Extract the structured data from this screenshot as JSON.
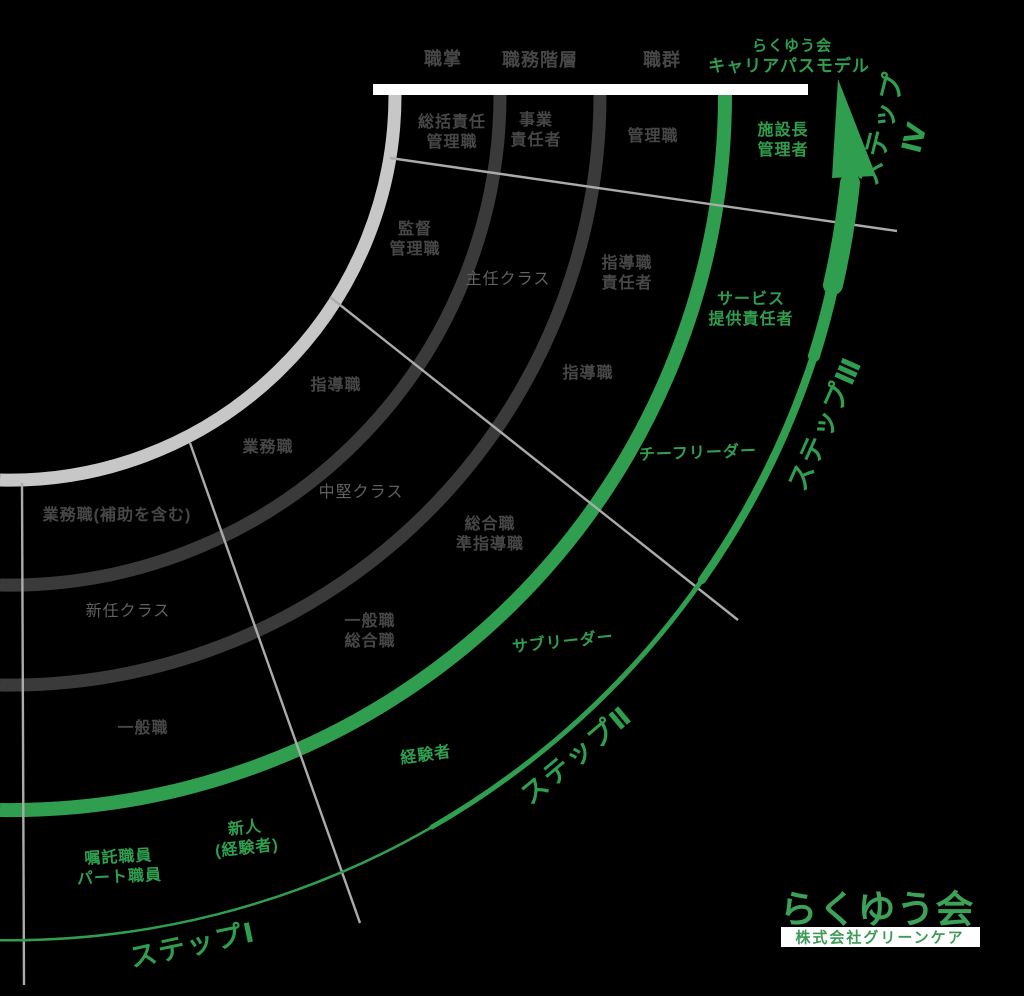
{
  "title": {
    "line1": "らくゆう会",
    "line2": "キャリアパスモデル"
  },
  "columns": [
    {
      "label": "職掌",
      "x": 443,
      "y": 59
    },
    {
      "label": "職務階層",
      "x": 540,
      "y": 60
    },
    {
      "label": "職群",
      "x": 662,
      "y": 60
    }
  ],
  "cells": [
    {
      "text": "総括責任\n管理職",
      "tone": "dark",
      "x": 452,
      "y": 133
    },
    {
      "text": "監督\n管理職",
      "tone": "dark",
      "x": 415,
      "y": 240
    },
    {
      "text": "指導職",
      "tone": "dark",
      "x": 336,
      "y": 386
    },
    {
      "text": "業務職",
      "tone": "dark",
      "x": 268,
      "y": 448
    },
    {
      "text": "業務職(補助を含む)",
      "tone": "dark",
      "x": 117,
      "y": 516
    },
    {
      "text": "事業\n責任者",
      "tone": "dark",
      "x": 536,
      "y": 131
    },
    {
      "text": "主任クラス",
      "tone": "muted",
      "x": 508,
      "y": 280
    },
    {
      "text": "中堅クラス",
      "tone": "muted",
      "x": 361,
      "y": 493
    },
    {
      "text": "新任クラス",
      "tone": "muted",
      "x": 128,
      "y": 612
    },
    {
      "text": "管理職",
      "tone": "dark",
      "x": 653,
      "y": 137
    },
    {
      "text": "指導職\n責任者",
      "tone": "dark",
      "x": 627,
      "y": 274
    },
    {
      "text": "指導職",
      "tone": "dark",
      "x": 588,
      "y": 374
    },
    {
      "text": "総合職\n準指導職",
      "tone": "dark",
      "x": 490,
      "y": 535
    },
    {
      "text": "一般職\n総合職",
      "tone": "dark",
      "x": 370,
      "y": 632
    },
    {
      "text": "一般職",
      "tone": "dark",
      "x": 143,
      "y": 729
    },
    {
      "text": "施設長\n管理者",
      "tone": "green",
      "x": 783,
      "y": 141
    },
    {
      "text": "サービス\n提供責任者",
      "tone": "green",
      "x": 751,
      "y": 310
    },
    {
      "text": "チーフリーダー",
      "tone": "green",
      "x": 698,
      "y": 454,
      "rot": -2
    },
    {
      "text": "サブリーダー",
      "tone": "green",
      "x": 563,
      "y": 643,
      "rot": -6
    },
    {
      "text": "経験者",
      "tone": "green",
      "x": 426,
      "y": 756,
      "rot": -8
    },
    {
      "text": "新人\n(経験者)",
      "tone": "green",
      "x": 246,
      "y": 839,
      "rot": -6
    },
    {
      "text": "嘱託職員\nパート職員",
      "tone": "green",
      "x": 119,
      "y": 868,
      "rot": -3
    }
  ],
  "steps": [
    {
      "label": "ステップⅠ",
      "x": 193,
      "y": 946,
      "rot": -12
    },
    {
      "label": "ステップⅡ",
      "x": 577,
      "y": 756,
      "rot": -40
    },
    {
      "label": "ステップⅢ",
      "x": 826,
      "y": 424,
      "rot": -66
    },
    {
      "label": "ステップⅣ",
      "x": 899,
      "y": 133,
      "rot": -76
    }
  ],
  "logo": {
    "name": "らくゆう会",
    "company": "株式会社グリーンケア"
  },
  "colors": {
    "background": "#000000",
    "career_green": "#2f9e4f",
    "dark_arc": "#3a3a3a",
    "light_arc": "#c7c7c7",
    "divider_gray": "#ababab",
    "dark_text": "#474747",
    "muted_text": "#616161",
    "white": "#ffffff",
    "logo_green": "#3ba258"
  }
}
